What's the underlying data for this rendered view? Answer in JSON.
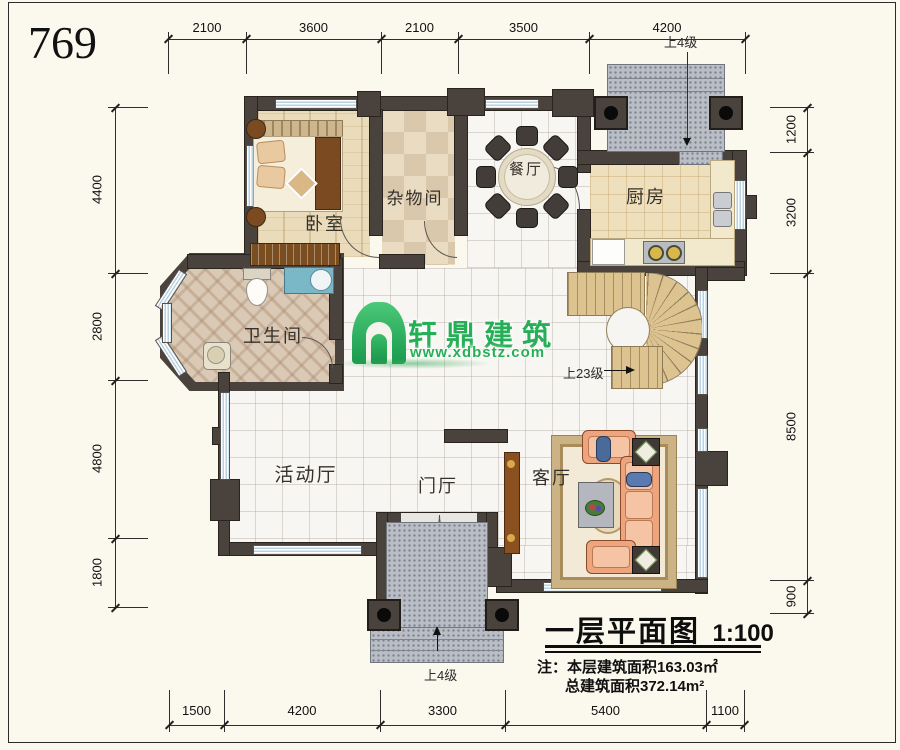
{
  "sheet": {
    "number": "769"
  },
  "watermark": {
    "brand": "轩鼎建筑",
    "url": "www.xdbstz.com"
  },
  "rooms": {
    "bedroom": "卧室",
    "storage": "杂物间",
    "dining": "餐厅",
    "kitchen": "厨房",
    "bathroom": "卫生间",
    "activity": "活动厅",
    "foyer": "门厅",
    "living": "客厅"
  },
  "annotations": {
    "stairs": "上23级",
    "porch_top": "上4级",
    "porch_bottom": "上4级"
  },
  "dims": {
    "top": [
      "2100",
      "3600",
      "2100",
      "3500",
      "4200"
    ],
    "bottom": [
      "1500",
      "4200",
      "3300",
      "5400",
      "1100"
    ],
    "left": [
      "4400",
      "2800",
      "4800",
      "1800"
    ],
    "right": [
      "1200",
      "3200",
      "8500",
      "900"
    ]
  },
  "title_block": {
    "title": "一层平面图",
    "scale": "1:100",
    "note_label": "注：",
    "note1": "本层建筑面积163.03㎡",
    "note2": "总建筑面积372.14m²"
  }
}
